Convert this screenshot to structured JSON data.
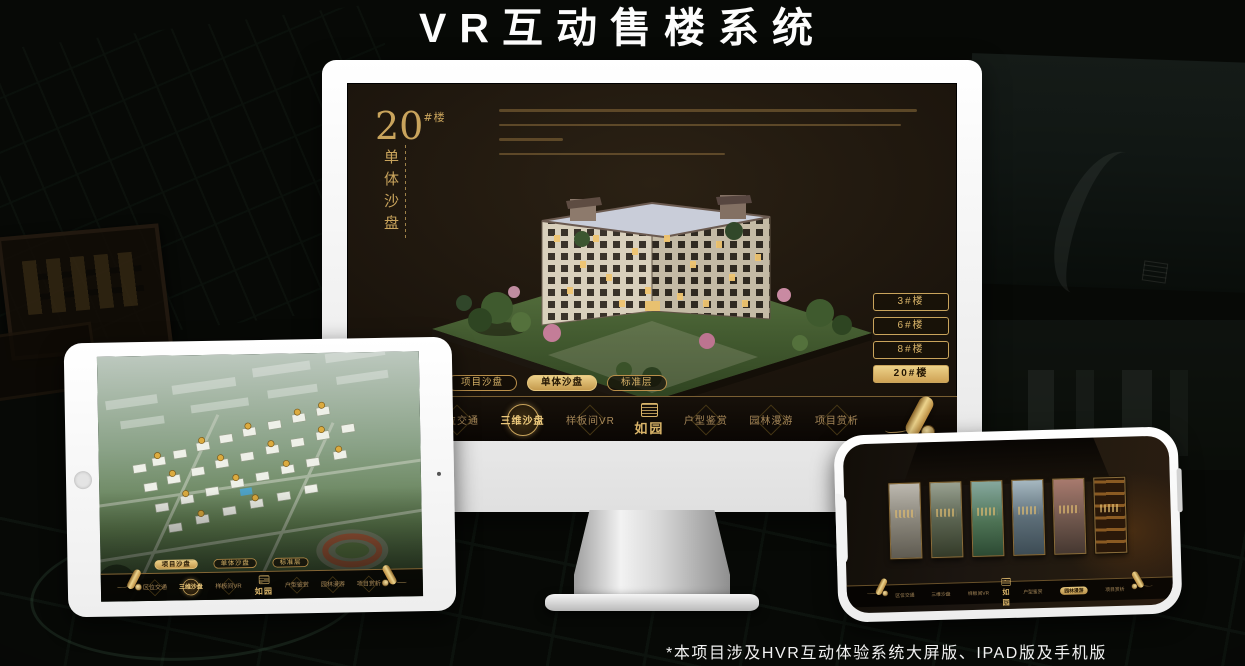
{
  "page": {
    "title": "VR互动售楼系统",
    "footnote": "*本项目涉及HVR互动体验系统大屏版、IPAD版及手机版"
  },
  "brand": {
    "logo": "如园",
    "logo_icon": "seal-icon"
  },
  "colors": {
    "gold": "#c9a45c",
    "gold_bright": "#dcb66e",
    "active_fill": "#e0bb6d",
    "screen_bg": "#1b140c",
    "frame_white": "#f4f4f2"
  },
  "nav_items": [
    {
      "label": "区位交通"
    },
    {
      "label": "三维沙盘"
    },
    {
      "label": "样板间VR"
    },
    {
      "label": "户型鉴赏"
    },
    {
      "label": "园林漫游"
    },
    {
      "label": "项目赏析"
    }
  ],
  "mode_tabs": [
    "项目沙盘",
    "单体沙盘",
    "标准层"
  ],
  "monitor": {
    "block_number": "20",
    "block_number_suffix": "#楼",
    "block_subtitle": "单体沙盘",
    "floor_buttons": [
      "3#楼",
      "6#楼",
      "8#楼",
      "20#楼"
    ],
    "active_floor": "20#楼",
    "active_mode": "单体沙盘",
    "active_nav": "三维沙盘",
    "end_icon": "scroll-icon"
  },
  "tablet": {
    "active_mode": "项目沙盘",
    "active_nav": "三维沙盘",
    "end_icon": "scroll-icon"
  },
  "phone": {
    "active_nav": "园林漫游",
    "end_icon": "scroll-icon"
  }
}
